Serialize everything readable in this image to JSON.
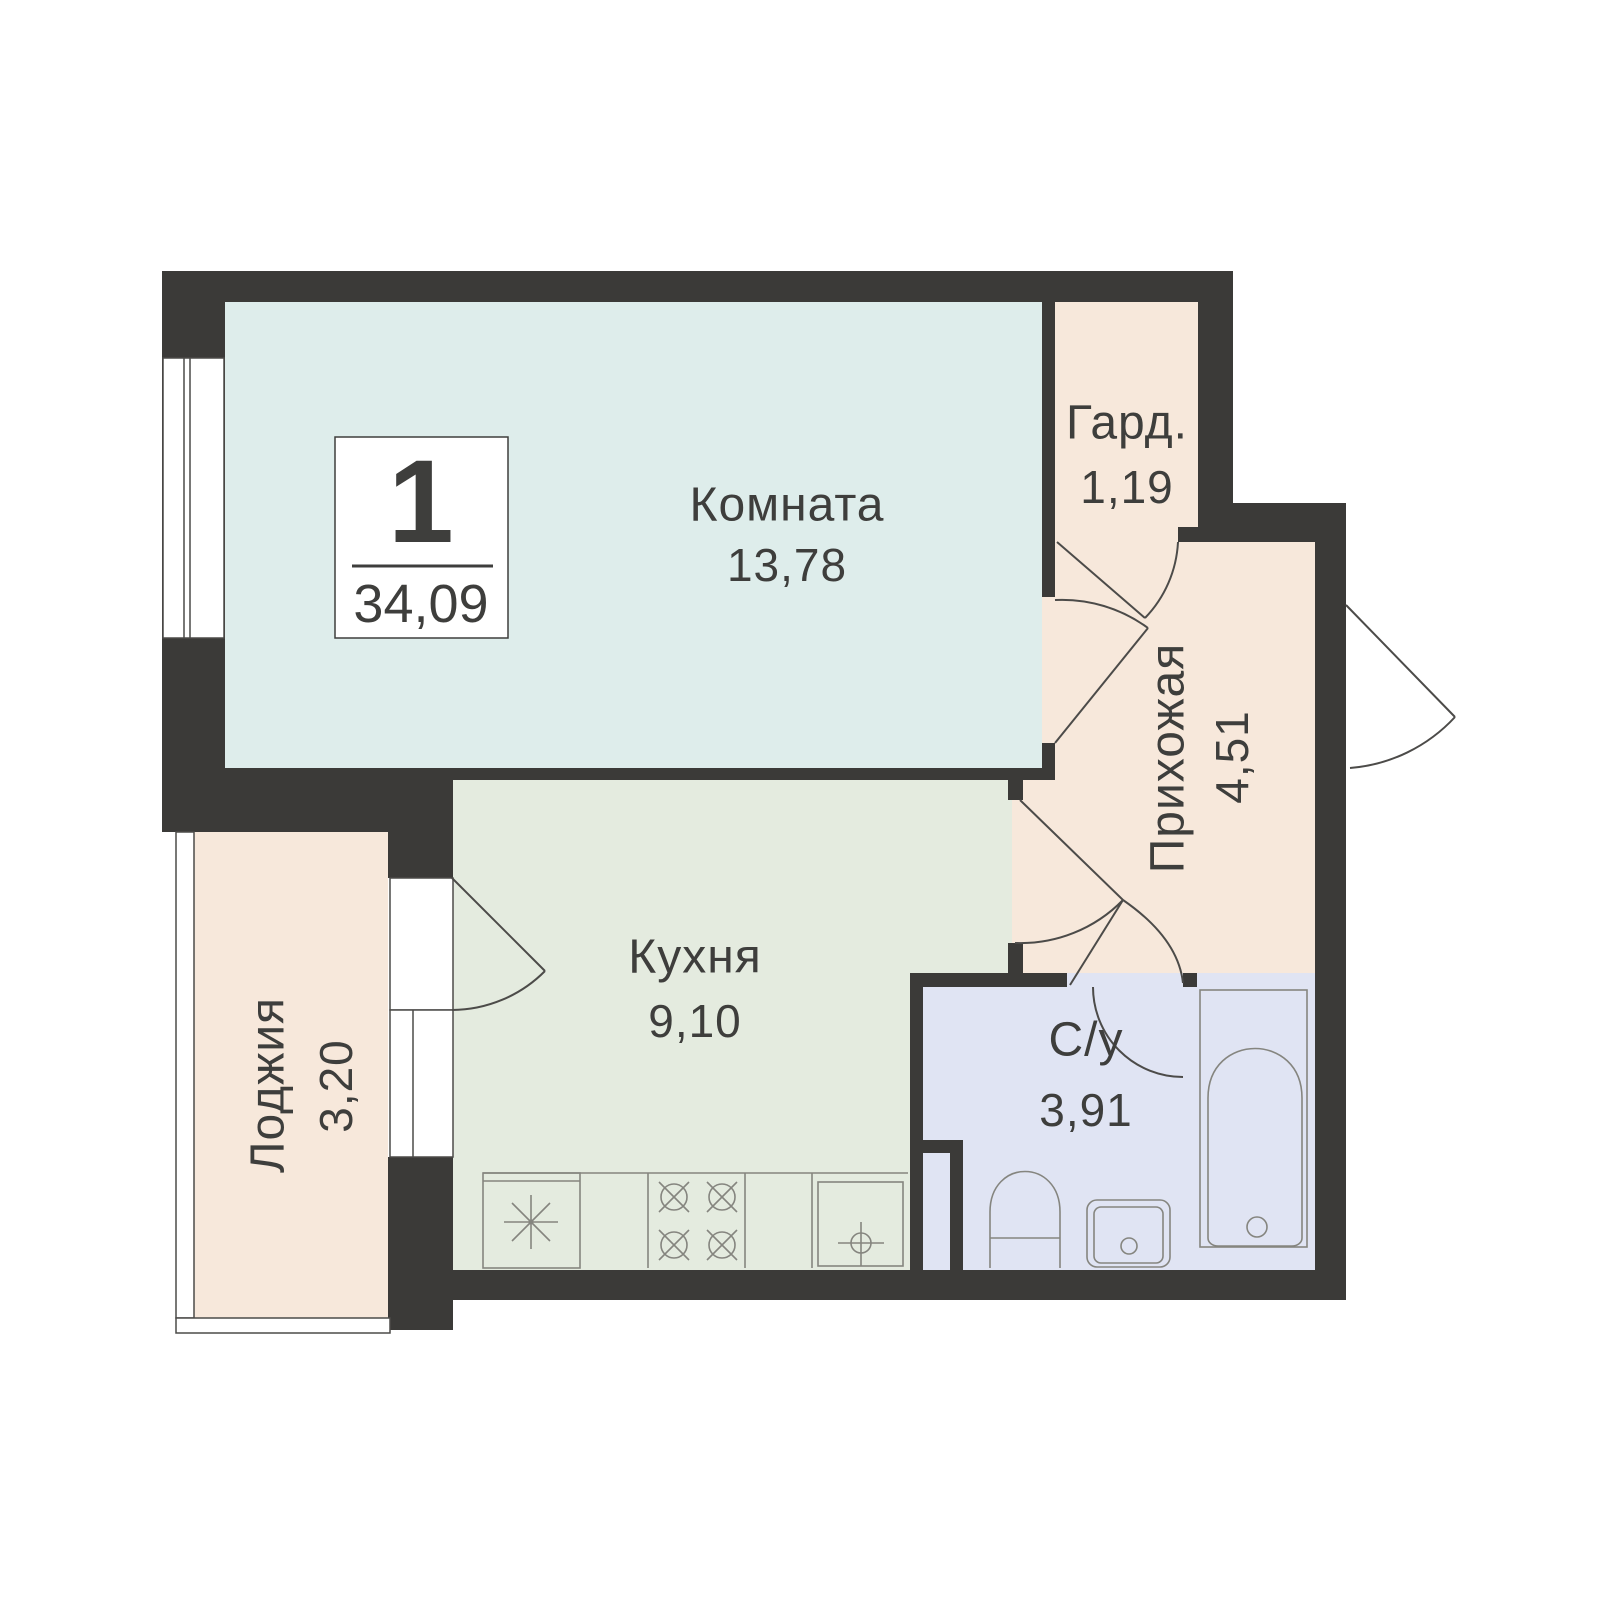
{
  "plan": {
    "badge": {
      "room_count": "1",
      "total_area": "34,09"
    },
    "rooms": [
      {
        "name": "Комната",
        "area": "13,78"
      },
      {
        "name": "Гард.",
        "area": "1,19"
      },
      {
        "name": "Прихожая",
        "area": "4,51"
      },
      {
        "name": "Кухня",
        "area": "9,10"
      },
      {
        "name": "С/у",
        "area": "3,91"
      },
      {
        "name": "Лоджия",
        "area": "3,20"
      }
    ],
    "colors": {
      "wall": "#3b3a38",
      "room": "#deedeb",
      "wardrobe": "#f7e8db",
      "hall": "#f7e8db",
      "kitchen": "#e4ebdf",
      "bathroom": "#e0e4f3",
      "loggia": "#f7e8db",
      "text": "#3e3e3c",
      "fixture": "#85857f",
      "door": "#4c4b49"
    }
  }
}
